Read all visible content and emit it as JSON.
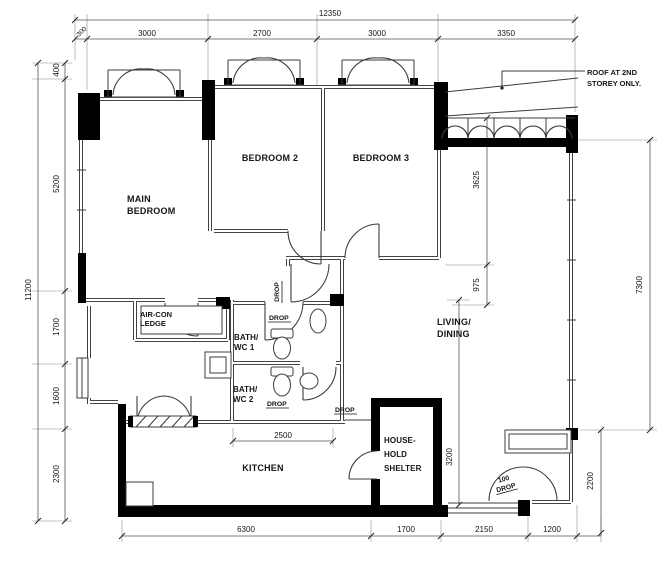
{
  "drawing": {
    "background": "#ffffff",
    "wall_color": "#000000",
    "line_color": "#3c3c3c"
  },
  "rooms": {
    "main_bedroom": {
      "l1": "MAIN",
      "l2": "BEDROOM"
    },
    "bedroom2": {
      "l1": "BEDROOM 2"
    },
    "bedroom3": {
      "l1": "BEDROOM 3"
    },
    "living": {
      "l1": "LIVING/",
      "l2": "DINING"
    },
    "kitchen": {
      "l1": "KITCHEN"
    },
    "bath1": {
      "l1": "BATH/",
      "l2": "WC 1"
    },
    "bath2": {
      "l1": "BATH/",
      "l2": "WC 2"
    },
    "aircon": {
      "l1": "AIR-CON",
      "l2": "LEDGE"
    },
    "shelter": {
      "l1": "HOUSE-",
      "l2": "HOLD",
      "l3": "SHELTER"
    }
  },
  "annotations": {
    "roof": {
      "l1": "ROOF AT 2ND",
      "l2": "STOREY ONLY."
    },
    "drop": "DROP",
    "drop_100": "100"
  },
  "dims": {
    "overall_width": "12350",
    "top": [
      "300",
      "3000",
      "2700",
      "3000",
      "3350"
    ],
    "overall_height": "11200",
    "left": [
      "400",
      "5200",
      "1700",
      "1600",
      "2300"
    ],
    "right_inner": [
      "3625",
      "975"
    ],
    "right_outer": [
      "7300",
      "2200"
    ],
    "bottom": [
      "6300",
      "1700",
      "2150",
      "1200"
    ],
    "bath_width": "2500",
    "shelter_height": "3200"
  }
}
